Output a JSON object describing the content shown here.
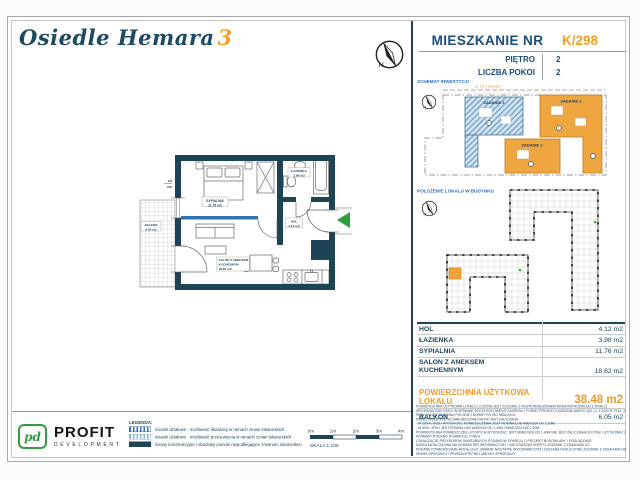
{
  "title": {
    "main": "Osiedle Hemara",
    "accent": "3"
  },
  "header": {
    "apartment_label": "MIESZKANIE NR",
    "apartment_number": "K/298",
    "floor_label": "PIĘTRO",
    "floor_value": "2",
    "rooms_label": "LICZBA POKOI",
    "rooms_value": "2"
  },
  "site_plan": {
    "title": "SCHEMAT INWESTYCJI",
    "street": "ul. M. Hemara",
    "zadanie1": "ZADANIE 1",
    "zadanie2a": "ZADANIE 2",
    "zadanie2b": "ZADANIE 2"
  },
  "location_plan": {
    "title": "POŁOŻENIE LOKALU W BUDYNKU"
  },
  "floor_plan": {
    "labels": {
      "sypialnia_name": "SYPIALNIA",
      "sypialnia_area": "11.76 m2",
      "lazienka_name": "ŁAZIENKA",
      "lazienka_area": "3.98 m2",
      "hol_name": "HOL",
      "hol_area": "4.12 m2",
      "salon_line1": "SALON Z ANEKSEM",
      "salon_line2": "KUCHENNYM",
      "salon_area": "18.62 m2",
      "balkon_name": "BALKON",
      "balkon_area": "6.05 m2",
      "window_mark_top": "1/8",
      "window_mark_bottom": "215"
    }
  },
  "area_table": {
    "rows": [
      {
        "name": "HOL",
        "value": "4.12 m2"
      },
      {
        "name": "ŁAZIENKA",
        "value": "3.98 m2"
      },
      {
        "name": "SYPIALNIA",
        "value": "11.76 m2"
      },
      {
        "name": "SALON Z ANEKSEM KUCHENNYM",
        "value": "18.62 m2"
      }
    ],
    "total_label": "POWIERZCHNIA UŻYTKOWA LOKALU",
    "total_value": "38.48 m2",
    "balcony_label": "BALKON",
    "balcony_value": "6.05 m2"
  },
  "disclaimer": {
    "lines": [
      "POWIERZCHNIA UŻYTKOWA LOKALU LICZONA JEST ZGODNIE Z ROZPORZĄDZENIEM MINISTRA ROZWOJU Z DNIA 11",
      "WRZEŚNIA 2020 ROKU W SPRAWIE SZCZEGÓŁOWEGO ZAKRESU I FORMY PROJEKTU BUDOWLANEGO (DZ. U. Z 2020 R. POZ. 1333)",
      "PRZY UWZGLĘDNIENIU POLSKIEJ NORMY PN-ISO 9836:2015.",
      "PRZESTRZEŃ POD ŚCIANKAMI DZIAŁOWYMI JEST ZALICZANA:",
      "- W 100%, JEŚLI WYSOKOŚĆ POMIESZCZENIA JEST RÓWNA LUB WIĘKSZA OD 2,20M,",
      "- W 50%, JEŚLI JEST RÓWNA LUB WIĘKSZA OD 1,40M I MNIEJSZA NIŻ 2,20M,",
      "POWIERZCHNIA POMIESZCZEŃ, KTÓRYCH WYSOKOŚĆ JEST MNIEJSZA OD 1,40M NIE JEST ZALICZANA DO POW. UŻYTKOWEJ LOKALU.",
      "WYMIARY PODANO W ŚWIETLE TYNKU.",
      "LOKALIZACJĘ PRZYBORÓW SANITARNYCH PODANO W OPARCIU O PROJEKT BUDOWLANY I POGLĄDOWO.",
      "KARTA KATALOGOWA MA CHARAKTER INFORMACYJNY I NIE STANOWI OFERTY ZGODNIE Z ZASADAMI KC.",
      "PODANE POWIERZCHNIE MOGĄ ULEC ZMIANIE NA ETAPIE WYKONAWCZYM I ZOSTANĄ ROZLICZONE ZGODNIE Z ZASADAMI UMOWY",
      "DEWELOPERSKIEJ / PRZEDWSTĘPNEJ UMOWY SPRZEDAŻY."
    ]
  },
  "legend": {
    "title": "LEGENDA:",
    "items": [
      {
        "label": "ścianki działowe - możliwość likwidacji w ramach zmian lokatorskich"
      },
      {
        "label": "ścianki działowe - możliwość przesunięcia w ramach zmian lokatorskich"
      },
      {
        "label": "ściany konstrukcyjne i obudowy pionów niepodlegające zmianom lokatorskim"
      }
    ]
  },
  "scale_bar": {
    "ticks": [
      "0m",
      "1m",
      "2m",
      "3m",
      "4m"
    ],
    "label": "SKALA 1:100"
  },
  "logo": {
    "monogram": "pd",
    "name": "PROFIT",
    "subtitle": "DEVELOPMENT"
  },
  "icons": {
    "compass_letter": "N"
  }
}
